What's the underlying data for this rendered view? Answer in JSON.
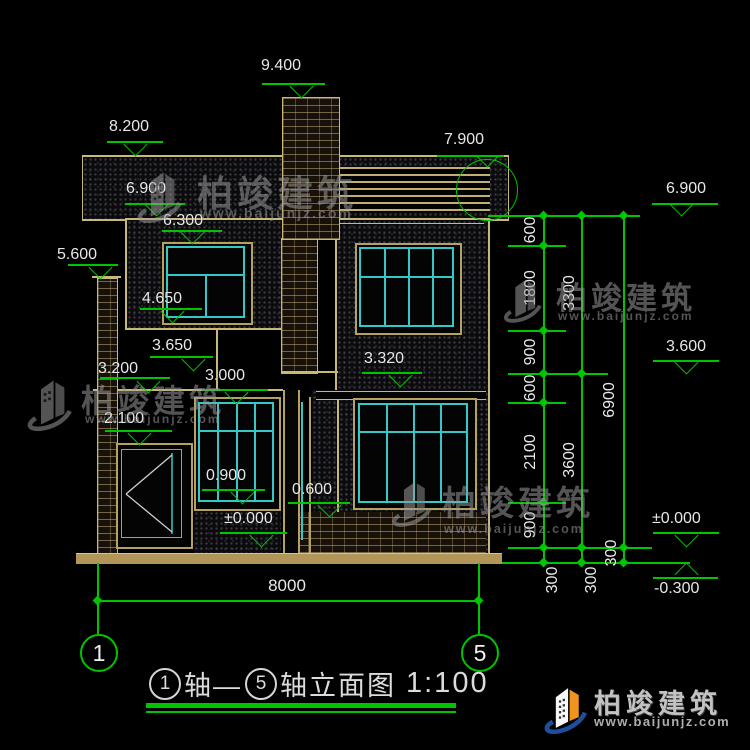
{
  "title": {
    "axis1": "1",
    "word1": "轴—",
    "axis2": "5",
    "word2": "轴立面图",
    "scale": "1:100"
  },
  "levels_left": [
    "9.400",
    "8.200",
    "7.900",
    "6.900",
    "6.300",
    "5.600",
    "4.650",
    "3.650",
    "3.320",
    "3.200",
    "3.000",
    "2.100",
    "0.900",
    "0.600",
    "±0.000"
  ],
  "levels_right": [
    "6.900",
    "3.600",
    "±0.000",
    "-0.300"
  ],
  "chain_inner": [
    "600",
    "1800",
    "900",
    "600",
    "2100",
    "900",
    "300"
  ],
  "chain_mid": [
    "3300",
    "3600",
    "300"
  ],
  "chain_outer": [
    "6900",
    "300"
  ],
  "dim_width": "8000",
  "axes": [
    "1",
    "5"
  ],
  "watermark": {
    "brand": "柏竣建筑",
    "site": "www.baijunjz.com"
  },
  "footer": {
    "brand": "柏竣建筑",
    "site": "www.baijunjz.com"
  },
  "colors": {
    "dim_green": "#00c400",
    "line_cream": "#c8b87a",
    "frame_cyan": "#35c8c8",
    "slab_tan": "#b29659"
  }
}
